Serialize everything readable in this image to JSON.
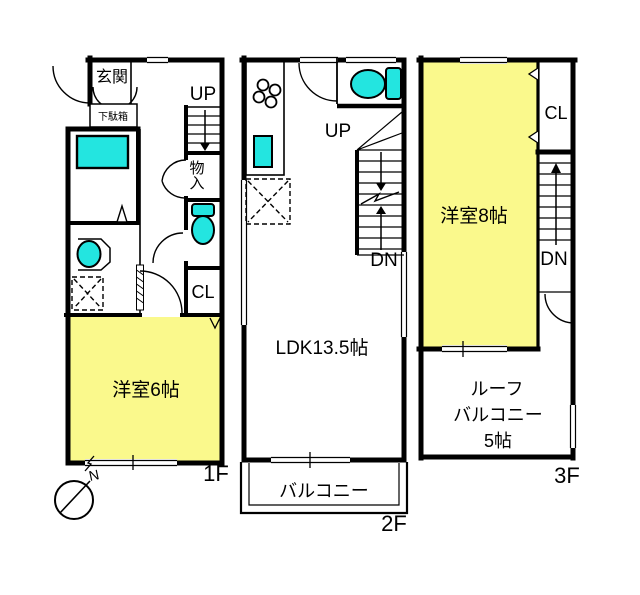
{
  "colors": {
    "room_yellow": "#FAF98C",
    "fixture_cyan": "#23E5E0",
    "wall_black": "#000000"
  },
  "compass": {
    "north": "N"
  },
  "floor1": {
    "entrance": "玄関",
    "shoe_cabinet": "下駄箱",
    "stairs_up": "UP",
    "storage": "物入",
    "closet": "CL",
    "bedroom": "洋室6帖",
    "floor_label": "1F"
  },
  "floor2": {
    "stairs_up": "UP",
    "stairs_down": "DN",
    "ldk": "LDK13.5帖",
    "balcony": "バルコニー",
    "floor_label": "2F"
  },
  "floor3": {
    "bedroom": "洋室8帖",
    "closet": "CL",
    "stairs_down": "DN",
    "roof_balcony": [
      "ルーフ",
      "バルコニー",
      "5帖"
    ],
    "floor_label": "3F"
  }
}
